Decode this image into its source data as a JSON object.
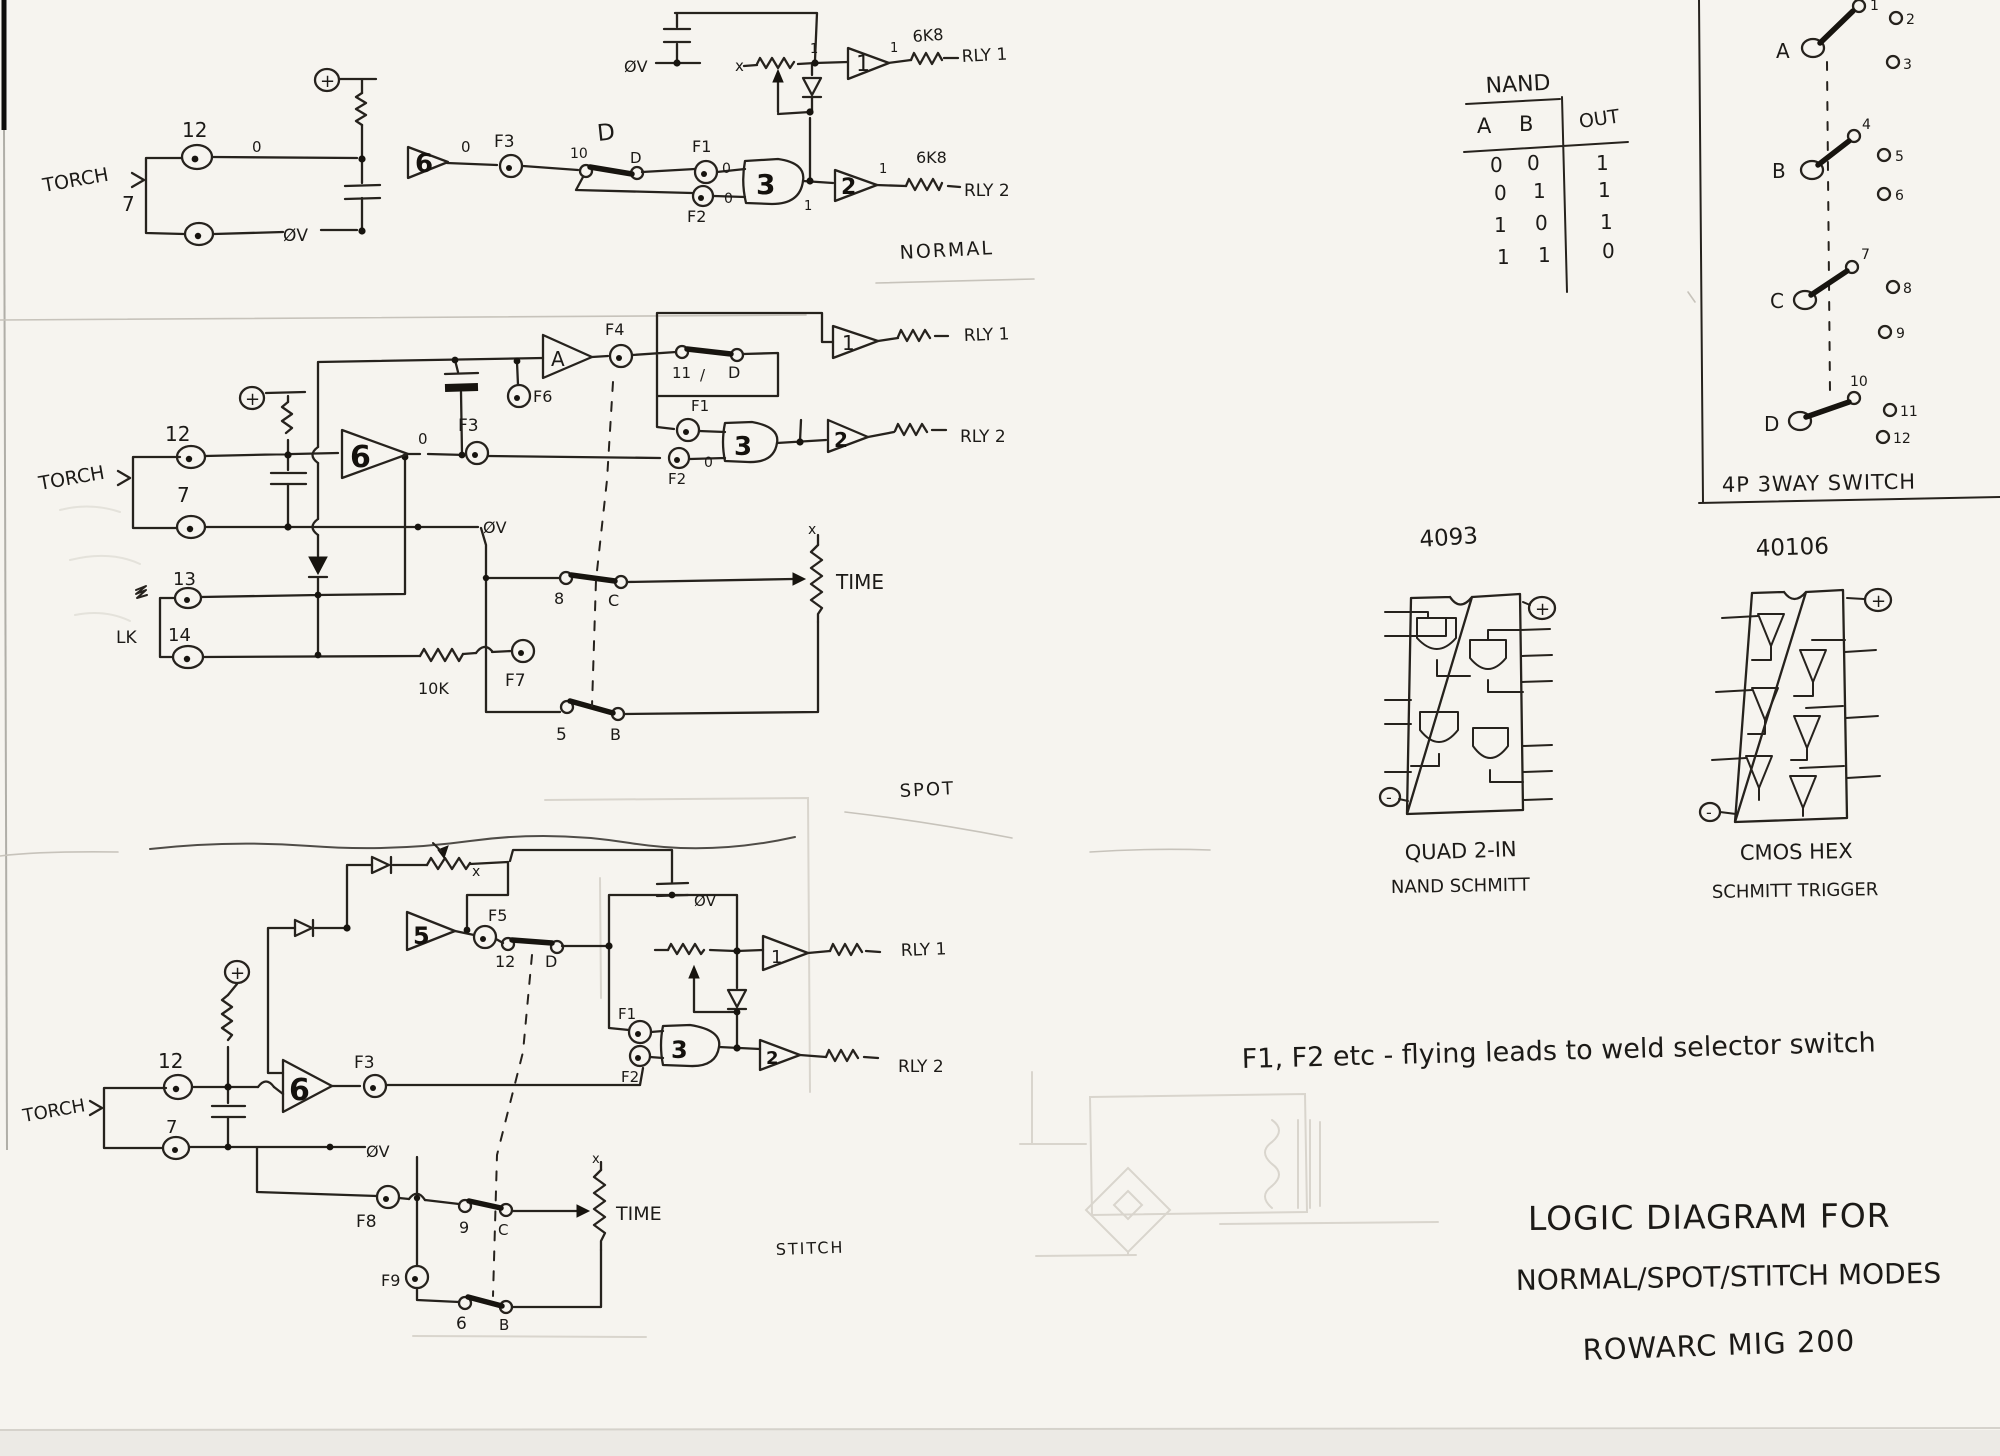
{
  "normal": {
    "caption": "NORMAL",
    "torch": "TORCH",
    "t12": "12",
    "t7": "7",
    "zero_a": "0",
    "zero_b": "0",
    "zero_c": "0",
    "zero_d": "0",
    "one_a": "1",
    "one_b": "1",
    "one_c": "1",
    "one_d": "1",
    "plus": "+",
    "ov_left": "ØV",
    "ov_top": "ØV",
    "f1": "F1",
    "f2": "F2",
    "f3": "F3",
    "sw_pos": "10",
    "sw_d": "D",
    "gang_d": "D",
    "g6": "6",
    "g3": "3",
    "g1": "1",
    "g2": "2",
    "x": "x",
    "r1": "6K8",
    "r2": "6K8",
    "rly1": "RLY 1",
    "rly2": "RLY 2"
  },
  "spot": {
    "caption": "SPOT",
    "torch": "TORCH",
    "t12": "12",
    "t7": "7",
    "t13": "13",
    "t14": "14",
    "lk": "LK",
    "plus": "+",
    "ov": "ØV",
    "zero_a": "0",
    "zero_b": "0",
    "f1": "F1",
    "f2": "F2",
    "f3": "F3",
    "f4": "F4",
    "f6": "F6",
    "f7": "F7",
    "gA": "A",
    "g6": "6",
    "g3": "3",
    "g1": "1",
    "g2": "2",
    "sw11": "11",
    "slash": "/",
    "swd": "D",
    "sw8": "8",
    "swc": "C",
    "sw5": "5",
    "swb": "B",
    "r10k": "10K",
    "x": "x",
    "time": "TIME",
    "rly1": "RLY 1",
    "rly2": "RLY 2"
  },
  "stitch": {
    "caption": "STITCH",
    "torch": "TORCH",
    "t12": "12",
    "t7": "7",
    "plus": "+",
    "ov_left": "ØV",
    "ov_right": "ØV",
    "f1": "F1",
    "f2": "F2",
    "f3": "F3",
    "f5": "F5",
    "f8": "F8",
    "f9": "F9",
    "g6": "6",
    "g5": "5",
    "g3": "3",
    "g1": "1",
    "g2": "2",
    "sw12": "12",
    "swd": "D",
    "sw9": "9",
    "swc": "C",
    "sw6": "6",
    "swb": "B",
    "x_a": "x",
    "x_b": "x",
    "time": "TIME",
    "rly1": "RLY 1",
    "rly2": "RLY 2"
  },
  "truth_table": {
    "title": "NAND",
    "a": "A",
    "b": "B",
    "out": "OUT",
    "rows": [
      [
        "0",
        "0",
        "1"
      ],
      [
        "0",
        "1",
        "1"
      ],
      [
        "1",
        "0",
        "1"
      ],
      [
        "1",
        "1",
        "0"
      ]
    ]
  },
  "switch_panel": {
    "caption": "4P 3WAY SWITCH",
    "a": "A",
    "b": "B",
    "c": "C",
    "d": "D",
    "c1": "1",
    "c2": "2",
    "c3": "3",
    "c4": "4",
    "c5": "5",
    "c6": "6",
    "c7": "7",
    "c8": "8",
    "c9": "9",
    "c10": "10",
    "c11": "11",
    "c12": "12"
  },
  "ic4093": {
    "part": "4093",
    "cap1": "QUAD 2-IN",
    "cap2": "NAND SCHMITT",
    "plus": "+",
    "minus": "-"
  },
  "ic40106": {
    "part": "40106",
    "cap1": "CMOS HEX",
    "cap2": "SCHMITT TRIGGER",
    "plus": "+",
    "minus": "-"
  },
  "notes": {
    "flying": "F1, F2 etc - flying leads to weld selector switch",
    "line1": "LOGIC DIAGRAM FOR",
    "line2": "NORMAL/SPOT/STITCH MODES",
    "line3": "ROWARC MIG 200"
  }
}
